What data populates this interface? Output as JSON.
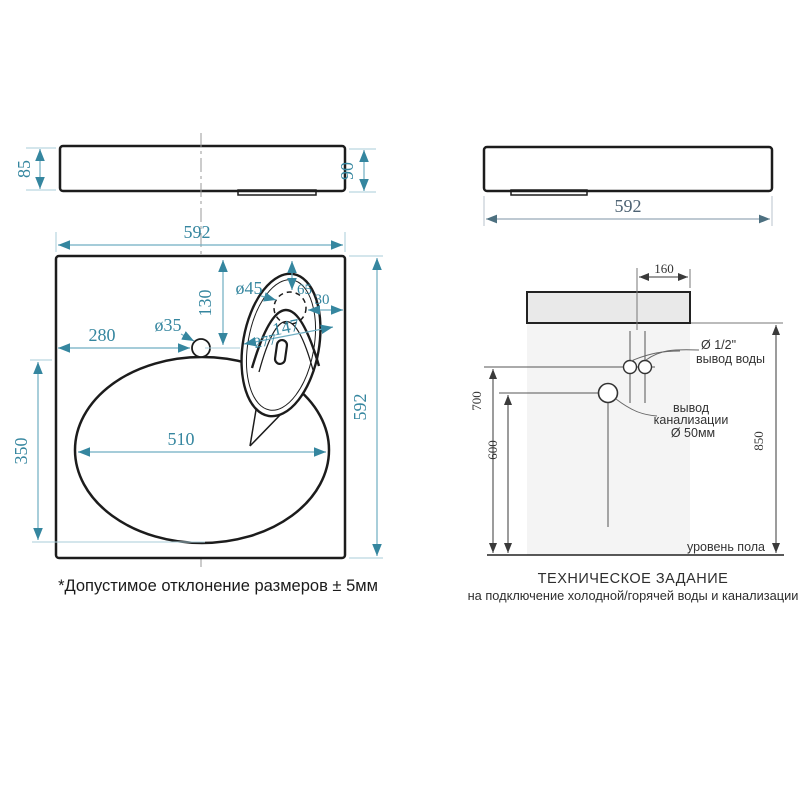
{
  "colors": {
    "dimension_accent": "#35869f",
    "dimension_line": "#6faec2",
    "drawing_outline": "#1c1c1c",
    "install_lines": "#3a3a3a",
    "sink_fill": "#e9e9e9",
    "wall_fill": "#f4f4f4"
  },
  "front_view": {
    "height_left": "85",
    "height_right": "90"
  },
  "side_view": {
    "width": "592"
  },
  "top_view": {
    "width": "592",
    "depth": "592",
    "bowl_width": "510",
    "bowl_depth": "350",
    "faucet_offset": "280",
    "faucet_from_back": "130",
    "faucet_hole": "ø35",
    "overflow_hole": "ø45",
    "overflow_a": "65",
    "overflow_b": "30",
    "overflow_c": "147",
    "overflow_d": "277"
  },
  "note": "*Допустимое отклонение размеров ± 5мм",
  "install": {
    "offset_water": "160",
    "water_height": "700",
    "drain_height": "600",
    "sink_height": "850",
    "water_dia": "Ø 1/2\"",
    "water_label": "вывод воды",
    "drain_label_line1": "вывод",
    "drain_label_line2": "канализации",
    "drain_dia": "Ø 50мм",
    "floor": "уровень пола",
    "title": "ТЕХНИЧЕСКОЕ ЗАДАНИЕ",
    "subtitle": "на подключение холодной/горячей воды и канализации"
  }
}
